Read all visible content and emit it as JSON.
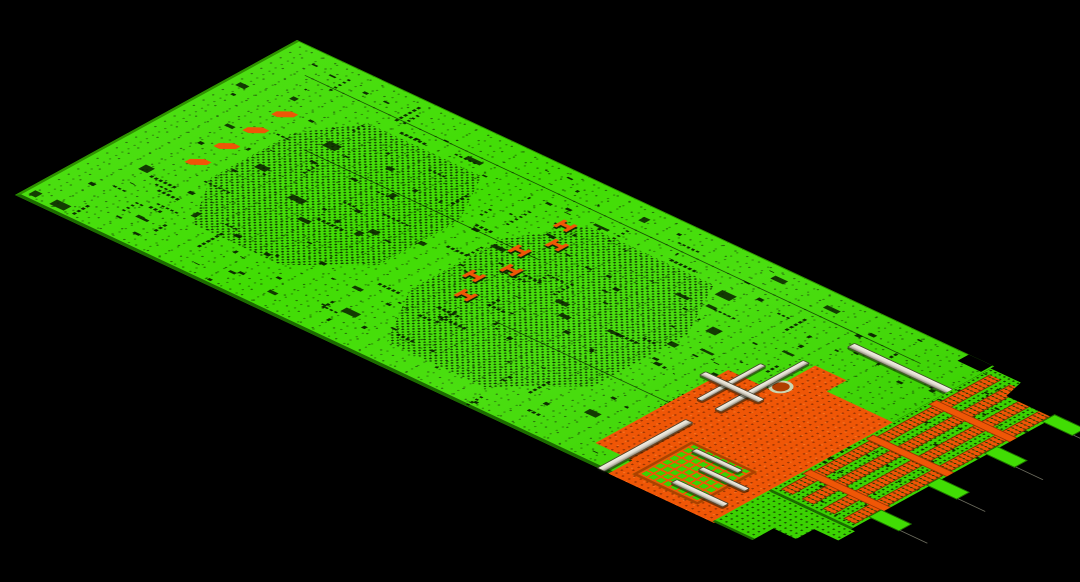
{
  "scene": {
    "width": 1080,
    "height": 582,
    "background": "#000000",
    "description": "3D perspective view of a long printed circuit board in an EDA layout viewport on a black background: bright green solder mask densely speckled with dark component pads, two large BGA via fan-out dot fields, orange copper and connector regions, light-grey slot connectors, four orange edge-connector pin bands and breakaway tabs with a stepped outline on the right end"
  },
  "board": {
    "transform_matrix": [
      0.9055,
      0.4239,
      -0.8758,
      0.4814,
      297,
      40
    ],
    "size_units": [
      770,
      322
    ],
    "corners_screen_px": {
      "top": [
        297,
        40
      ],
      "right": [
        987,
        363
      ],
      "bottom": [
        810,
        567
      ],
      "left": [
        15,
        195
      ]
    },
    "colors": {
      "green": "#41dd04",
      "green_dim": "#3bd202",
      "green_hi": "#52ea10",
      "dark_pad": "#0b2400",
      "copper": "#ef5606",
      "copper_dark": "#b03e00",
      "conn": "#ded9cd",
      "conn_hi": "#f5f2e8",
      "conn_shadow": "#8e8a7a",
      "conn_edge": "#4a4736",
      "board_edge": "#1c6c00",
      "board_edge_hi": "#2f9200",
      "outline": "#6d6d5f",
      "hole_ring": "#ccd6b2"
    },
    "features": {
      "bga_fanout_fields": [
        {
          "x": 95,
          "y": 55,
          "w": 195,
          "h": 205
        },
        {
          "x": 335,
          "y": 55,
          "w": 215,
          "h": 235
        }
      ],
      "inductor_row": {
        "x": 62,
        "y": 82,
        "count": 4,
        "spacing": 33
      },
      "capacitor_bank": {
        "x": 351,
        "x2": 367,
        "y": 60,
        "count": 6,
        "spacing": 26
      },
      "copper_zone": {
        "x": 612,
        "y": 92,
        "w": 158,
        "h": 230
      },
      "socket_grid": {
        "x": 668,
        "y": 242,
        "w": 72,
        "h": 68
      },
      "mounting_hole": {
        "x": 652,
        "y": 124,
        "d": 20
      },
      "connector_bars": [
        [
          658,
          46,
          110,
          9
        ],
        [
          646,
          92,
          8,
          102
        ],
        [
          640,
          220,
          9,
          102
        ],
        [
          700,
          292,
          58,
          8
        ],
        [
          624,
          118,
          7,
          74
        ],
        [
          600,
          156,
          66,
          8
        ],
        [
          678,
          247,
          52,
          7
        ],
        [
          702,
          264,
          52,
          7
        ]
      ],
      "edge_extension": {
        "x": 770,
        "y": 4,
        "w": 98,
        "h": 254,
        "band_count": 4,
        "band_width": 13,
        "band_gap": 10,
        "band_x0": 6,
        "band_y0": 8,
        "band_h": 238,
        "bridge_ys": [
          64,
          136,
          208
        ]
      },
      "breakaway_tabs": [
        22,
        88,
        154,
        220
      ],
      "bottom_step": {
        "x": 770,
        "y": 258,
        "w": 96,
        "h": 64
      },
      "notch": {
        "x": 742,
        "y": 0,
        "w": 26,
        "h": 13
      },
      "trace_lines": [
        [
          40,
          34,
          680
        ],
        [
          120,
          118,
          260
        ],
        [
          420,
          210,
          220
        ]
      ],
      "speckles": {
        "seed": 42,
        "singles": 150,
        "chunks": 46,
        "rows": 70,
        "ext_singles": 120
      }
    }
  }
}
